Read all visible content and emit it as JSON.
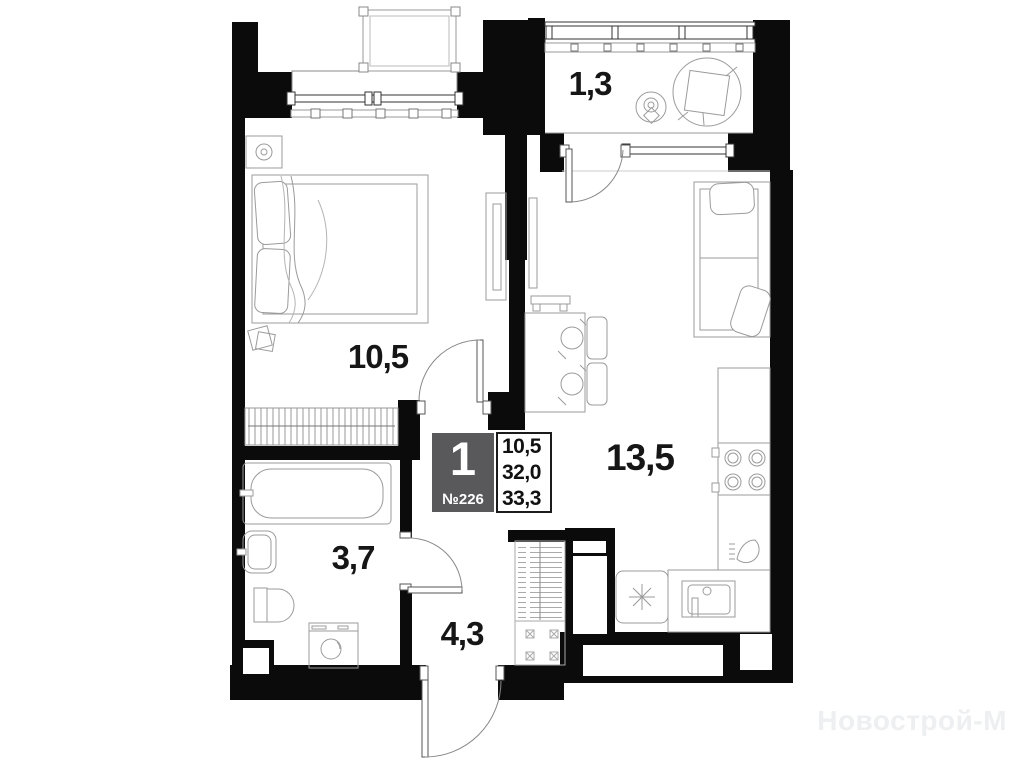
{
  "plan": {
    "unit": {
      "rooms_count": "1",
      "number": "№226",
      "area_living": "10,5",
      "area_no_balcony": "32,0",
      "area_total": "33,3"
    },
    "rooms": [
      {
        "id": "bedroom",
        "label": "10,5"
      },
      {
        "id": "living-kitchen",
        "label": "13,5"
      },
      {
        "id": "balcony",
        "label": "1,3"
      },
      {
        "id": "bathroom",
        "label": "3,7"
      },
      {
        "id": "hallway",
        "label": "4,3"
      }
    ],
    "watermark": "Новострой-М",
    "colors": {
      "wall": "#0b0b0b",
      "furniture_line": "#9b9b9b",
      "info_box": "#59595b",
      "label_text": "#161616",
      "watermark": "#edeff0"
    }
  }
}
